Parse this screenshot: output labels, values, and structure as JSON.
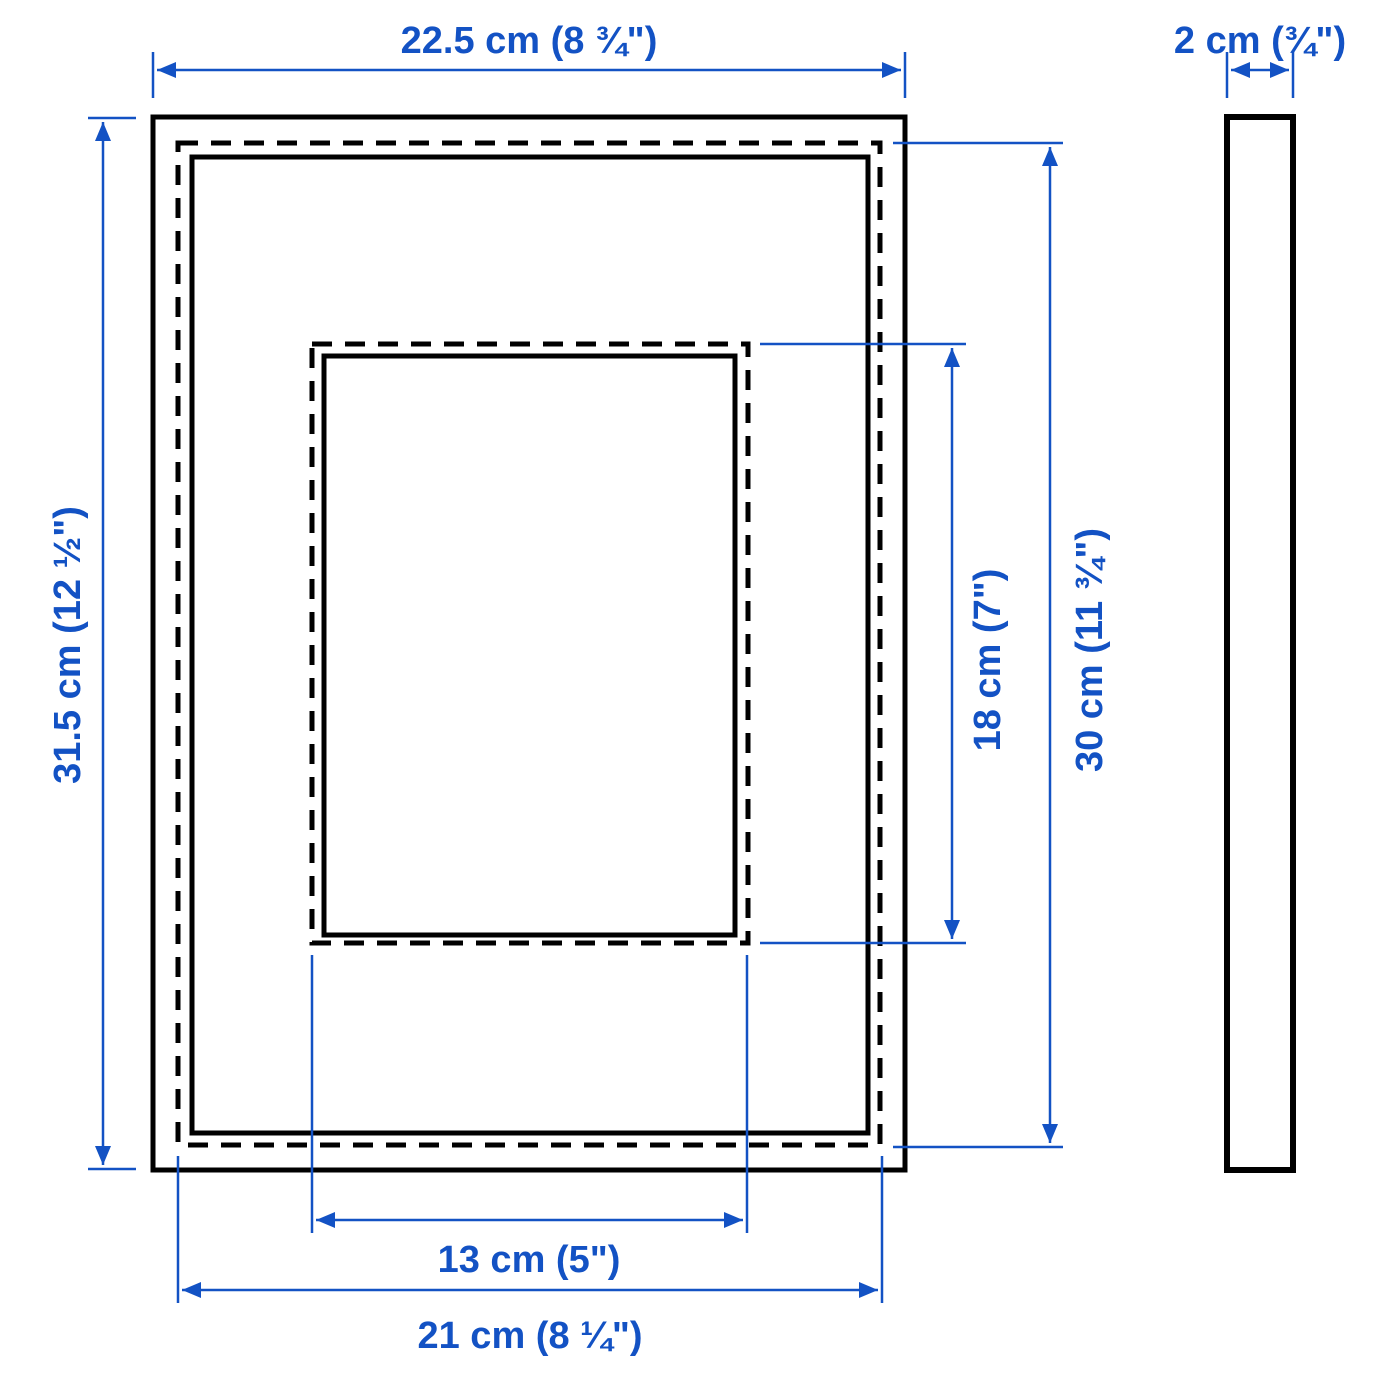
{
  "diagram": {
    "colors": {
      "dimension_blue": "#1352c4",
      "outline_black": "#000000",
      "background": "#ffffff"
    },
    "labels": {
      "outer_width": "22.5 cm (8 ¾\")",
      "frame_depth": "2 cm (¾\")",
      "outer_height": "31.5 cm (12 ½\")",
      "picture_opening_height": "18 cm (7\")",
      "back_picture_height": "30 cm (11 ¾\")",
      "picture_opening_width": "13 cm (5\")",
      "back_picture_width": "21 cm (8 ¼\")"
    }
  }
}
